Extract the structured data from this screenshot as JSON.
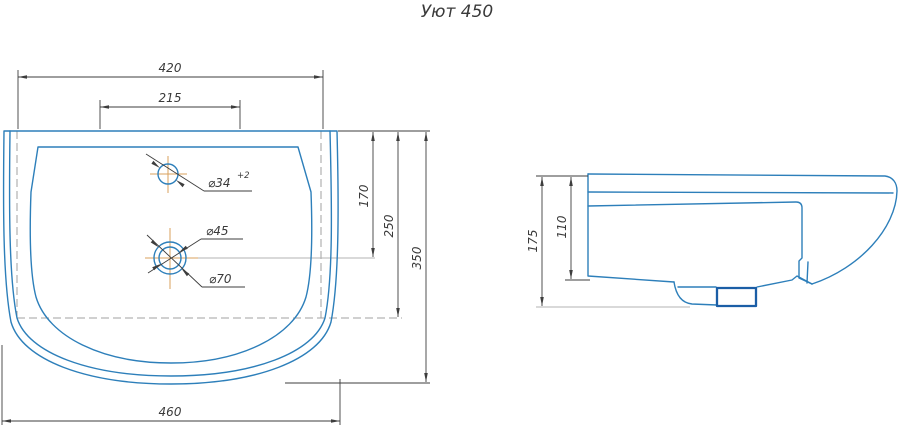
{
  "title": "Уют 450",
  "colors": {
    "outline": "#2d7fba",
    "outline_bold": "#1b5ea6",
    "dimension": "#3d3d3d",
    "text": "#3a3a3a",
    "hidden": "#a0a0a0",
    "centerline": "#d9a25e",
    "light_ext": "#b3b3b3"
  },
  "top_view": {
    "dims": {
      "back_width": "420",
      "faucet_platform_width": "215",
      "drain_depth": "170",
      "body_depth": "250",
      "overall_depth": "350",
      "overall_width": "460",
      "faucet_hole_dia": "⌀34",
      "faucet_hole_tol": "+2",
      "drain_inner_dia": "⌀45",
      "drain_outer_dia": "⌀70"
    }
  },
  "side_view": {
    "dims": {
      "overall_height": "175",
      "body_height": "110"
    }
  }
}
